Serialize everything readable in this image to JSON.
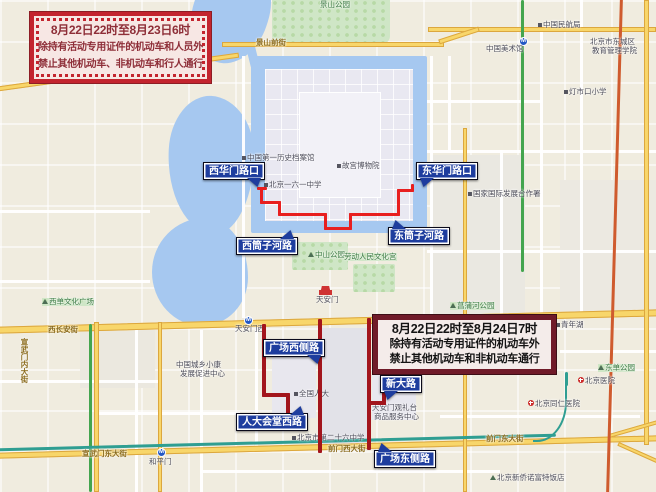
{
  "notices": [
    {
      "id": "notice-1",
      "lines": [
        "8月22日22时至8月23日6时",
        "除持有活动专用证件的机动车和人员外",
        "禁止其他机动车、非机动车和行人通行"
      ]
    },
    {
      "id": "notice-2",
      "lines": [
        "8月22日22时至8月24日7时",
        "除持有活动专用证件的机动车外",
        "禁止其他机动车和非机动车通行"
      ]
    }
  ],
  "callouts": [
    {
      "label": "西华门路口",
      "x": 203,
      "y": 162,
      "dir": "br"
    },
    {
      "label": "东华门路口",
      "x": 416,
      "y": 162,
      "dir": "bl"
    },
    {
      "label": "西筒子河路",
      "x": 236,
      "y": 237,
      "dir": "tr"
    },
    {
      "label": "东筒子河路",
      "x": 388,
      "y": 227,
      "dir": "tl"
    },
    {
      "label": "广场西侧路",
      "x": 263,
      "y": 339,
      "dir": "br"
    },
    {
      "label": "人大会堂西路",
      "x": 236,
      "y": 413,
      "dir": "tr"
    },
    {
      "label": "新大路",
      "x": 380,
      "y": 375,
      "dir": "bl"
    },
    {
      "label": "广场东侧路",
      "x": 374,
      "y": 450,
      "dir": "tl"
    }
  ],
  "routes": [
    {
      "name": "莫斯科路线-筒子河段(禁行机动车/非机动车/行人)",
      "color": "#e81f1f",
      "segments": [
        [
          257,
          187,
          10,
          3
        ],
        [
          260,
          187,
          3,
          17
        ],
        [
          260,
          201,
          21,
          3
        ],
        [
          278,
          201,
          3,
          15
        ],
        [
          278,
          213,
          49,
          3
        ],
        [
          324,
          213,
          3,
          17
        ],
        [
          324,
          227,
          28,
          3
        ],
        [
          349,
          213,
          3,
          17
        ],
        [
          349,
          213,
          51,
          3
        ],
        [
          397,
          189,
          3,
          27
        ],
        [
          397,
          189,
          17,
          3
        ],
        [
          411,
          184,
          3,
          8
        ]
      ]
    },
    {
      "name": "广场周边路线(禁行机动车/非机动车)",
      "color": "#a2151c",
      "segments": [
        [
          262,
          324,
          4,
          73
        ],
        [
          262,
          393,
          28,
          4
        ],
        [
          286,
          393,
          4,
          33
        ],
        [
          318,
          319,
          4,
          134
        ],
        [
          367,
          318,
          4,
          132
        ],
        [
          367,
          401,
          19,
          4
        ],
        [
          382,
          392,
          4,
          13
        ]
      ]
    }
  ],
  "map_labels": [
    {
      "t": "景山公园",
      "x": 320,
      "y": 1,
      "cls": "park"
    },
    {
      "t": "中国民航局",
      "x": 538,
      "y": 21,
      "icon": "dot"
    },
    {
      "t": "北京市东城区",
      "x": 590,
      "y": 38
    },
    {
      "t": "教育管理学院",
      "x": 592,
      "y": 47
    },
    {
      "t": "中国美术馆",
      "x": 486,
      "y": 45
    },
    {
      "t": "灯市口小学",
      "x": 564,
      "y": 88,
      "icon": "dot"
    },
    {
      "t": "中国第一历史档案馆",
      "x": 242,
      "y": 154,
      "icon": "dot"
    },
    {
      "t": "故宫博物院",
      "x": 337,
      "y": 162,
      "icon": "dot"
    },
    {
      "t": "北京一六一中学",
      "x": 264,
      "y": 181,
      "icon": "dot"
    },
    {
      "t": "国家国际发展合作署",
      "x": 468,
      "y": 190,
      "icon": "dot"
    },
    {
      "t": "中山公园",
      "x": 308,
      "y": 251,
      "icon": "tri",
      "cls": "park"
    },
    {
      "t": "劳动人民文化宫",
      "x": 344,
      "y": 253,
      "cls": "park"
    },
    {
      "t": "天安门",
      "x": 316,
      "y": 296
    },
    {
      "t": "菖蒲河公园",
      "x": 450,
      "y": 302,
      "icon": "tri",
      "cls": "park"
    },
    {
      "t": "青年湖",
      "x": 556,
      "y": 321,
      "icon": "dot"
    },
    {
      "t": "西单文化广场",
      "x": 42,
      "y": 298,
      "icon": "tri",
      "cls": "park"
    },
    {
      "t": "中国城乡小康",
      "x": 176,
      "y": 361
    },
    {
      "t": "发展促进中心",
      "x": 180,
      "y": 370
    },
    {
      "t": "全国人大",
      "x": 294,
      "y": 390,
      "icon": "dot"
    },
    {
      "t": "天安门观礼台",
      "x": 372,
      "y": 404
    },
    {
      "t": "商品服务中心",
      "x": 374,
      "y": 413
    },
    {
      "t": "东单公园",
      "x": 598,
      "y": 364,
      "icon": "tri",
      "cls": "park"
    },
    {
      "t": "北京医院",
      "x": 578,
      "y": 377,
      "icon": "hosp"
    },
    {
      "t": "北京同仁医院",
      "x": 528,
      "y": 400,
      "icon": "hosp"
    },
    {
      "t": "北京市第二十六中学",
      "x": 292,
      "y": 434,
      "icon": "dot"
    },
    {
      "t": "北京新侨诺富特饭店",
      "x": 490,
      "y": 474,
      "icon": "tri"
    },
    {
      "t": "和平门",
      "x": 149,
      "y": 458
    },
    {
      "t": "天安门西",
      "x": 235,
      "y": 325
    },
    {
      "t": "西长安街",
      "x": 48,
      "y": 326,
      "cls": "road"
    },
    {
      "t": "景山前街",
      "x": 256,
      "y": 39,
      "cls": "road"
    },
    {
      "t": "前门西大街",
      "x": 328,
      "y": 445,
      "cls": "road"
    },
    {
      "t": "前门东大街",
      "x": 486,
      "y": 435,
      "cls": "road"
    },
    {
      "t": "宣武门东大街",
      "x": 82,
      "y": 450,
      "cls": "road"
    },
    {
      "t": "宣武门内大街",
      "x": 20,
      "y": 338,
      "cls": "road",
      "vert": true
    }
  ],
  "metro_stations": [
    {
      "name": "天安门西",
      "x": 244,
      "y": 316
    },
    {
      "name": "和平门",
      "x": 157,
      "y": 448
    },
    {
      "name": "中国美术馆",
      "x": 519,
      "y": 37
    }
  ],
  "landmark_icons": [
    {
      "name": "tiananmen-gate",
      "x": 319,
      "y": 286
    }
  ],
  "colors": {
    "map_background": "#f0ecdf",
    "water": "#a6c8f0",
    "park": "#cfe6c6",
    "road_yellow": "#f8d66a",
    "route_red": "#e81f1f",
    "route_dark_red": "#a2151c",
    "callout_blue": "#1e3d9e",
    "notice1_border": "#c3242e",
    "notice1_text": "#8e2e38",
    "notice2_border": "#701b29",
    "transit_green": "#44a54e",
    "transit_teal": "#2f9e92",
    "transit_orange": "#cf5b2e"
  }
}
